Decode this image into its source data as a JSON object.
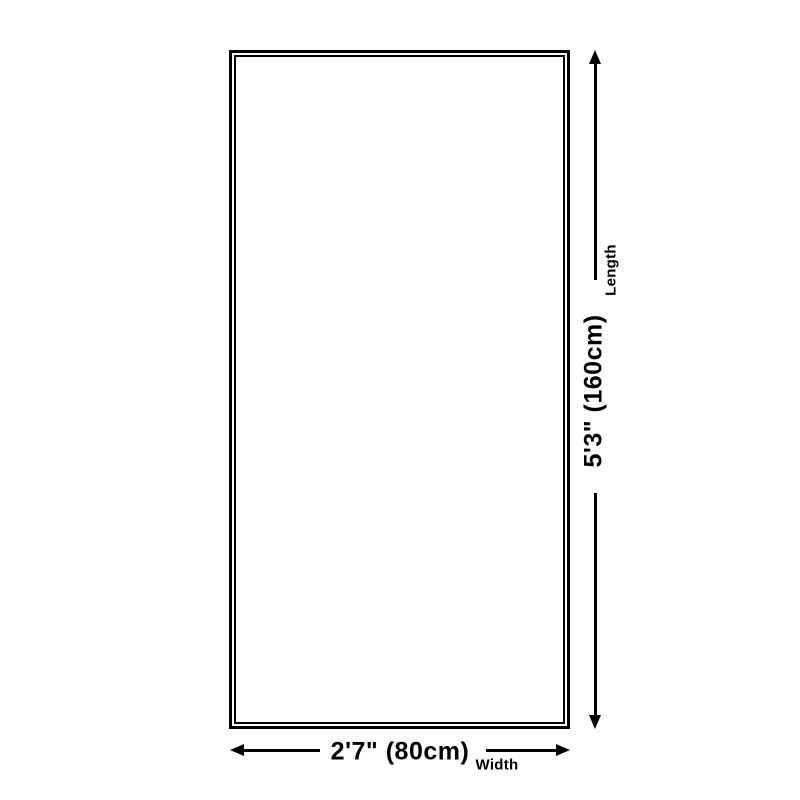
{
  "diagram": {
    "type": "product-dimension-diagram",
    "length": {
      "value": "5'3\" (160cm)",
      "label": "Length"
    },
    "width": {
      "value": "2'7\" (80cm)",
      "label": "Width"
    }
  },
  "colors": {
    "line": "#000000",
    "background": "#ffffff"
  }
}
